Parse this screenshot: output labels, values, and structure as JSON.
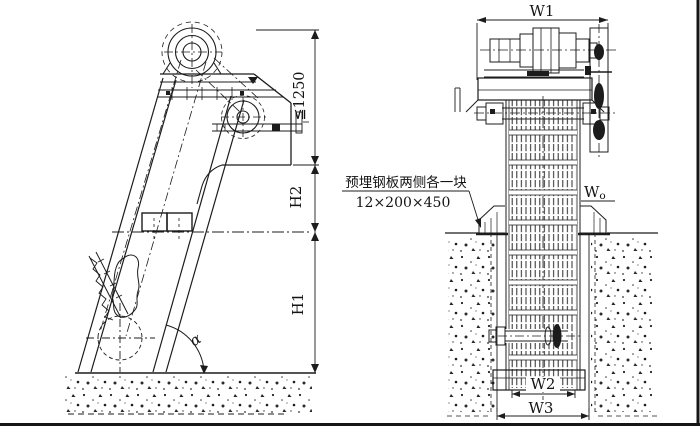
{
  "page": {
    "background": "#ffffff",
    "ink": "#1c1c1c"
  },
  "drawing": {
    "side_view": {
      "dim_discharge_max": "≦1250",
      "dim_h2": "H2",
      "dim_h1": "H1",
      "angle_alpha": "α"
    },
    "front_view": {
      "dim_w1": "W1",
      "dim_w0_main": "W",
      "dim_w0_sub": "o",
      "dim_w2": "W2",
      "dim_w3": "W3"
    },
    "note": {
      "line1": "预埋钢板两侧各一块",
      "line2": "12×200×450"
    }
  }
}
